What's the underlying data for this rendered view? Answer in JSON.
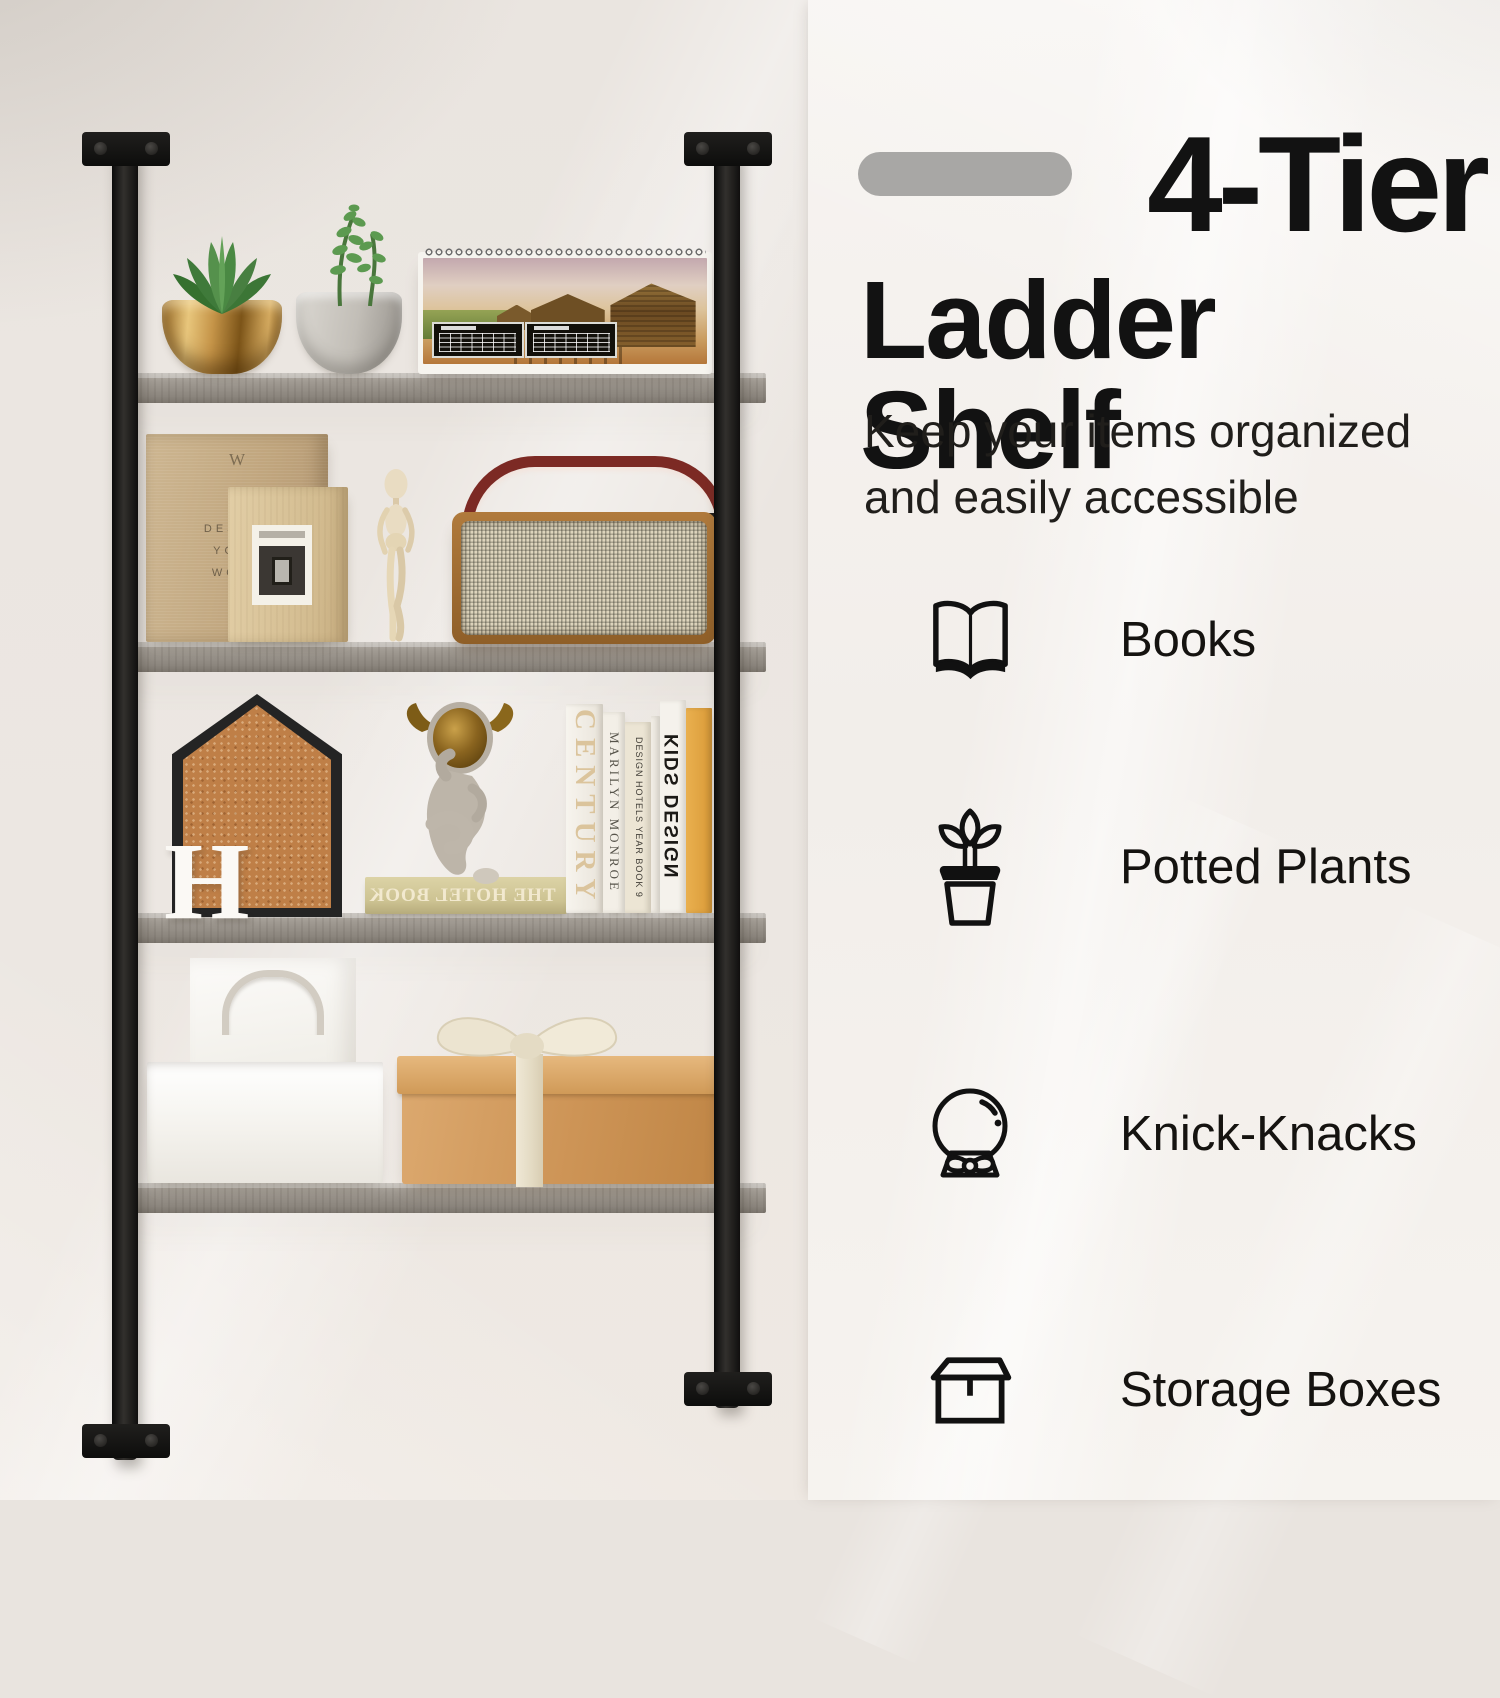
{
  "title": {
    "line1": "4-Tier",
    "line2": "Ladder Shelf"
  },
  "subtitle": {
    "line1": "Keep your items organized",
    "line2": "and easily accessible"
  },
  "features": [
    {
      "icon": "open-book-icon",
      "label": "Books"
    },
    {
      "icon": "potted-plant-icon",
      "label": "Potted Plants"
    },
    {
      "icon": "snow-globe-icon",
      "label": "Knick-Knacks"
    },
    {
      "icon": "storage-box-icon",
      "label": "Storage Boxes"
    }
  ],
  "shelf_scene": {
    "tier_count": 4,
    "monogram_letter": "H",
    "flat_book_title": "THE HOTEL BOOK",
    "standing_book_spines": [
      "CENTURY",
      "MARILYN MONROE",
      "DESIGN HOTELS YEAR BOOK 9",
      "KIDS DESIGN"
    ],
    "notebook_logo": "W",
    "notebook_cover_lines": [
      "DESIGN",
      "YOUR",
      "WORK"
    ]
  },
  "colors": {
    "pill_gray": "#a8a7a5",
    "title_black": "#121212",
    "body_text": "#201e1b",
    "wall_left": "#eae5e0",
    "panel_right": "#f5f2ee",
    "shelf_board_gray": "#9c968e",
    "frame_black": "#171717",
    "cork": "#bf7f47",
    "gift_box_tan": "#cd9456",
    "radio_wood": "#a06a32",
    "handle_red": "#7c2a24",
    "plant_green": "#4e8a4b",
    "gold_pot": "#c6964b"
  }
}
